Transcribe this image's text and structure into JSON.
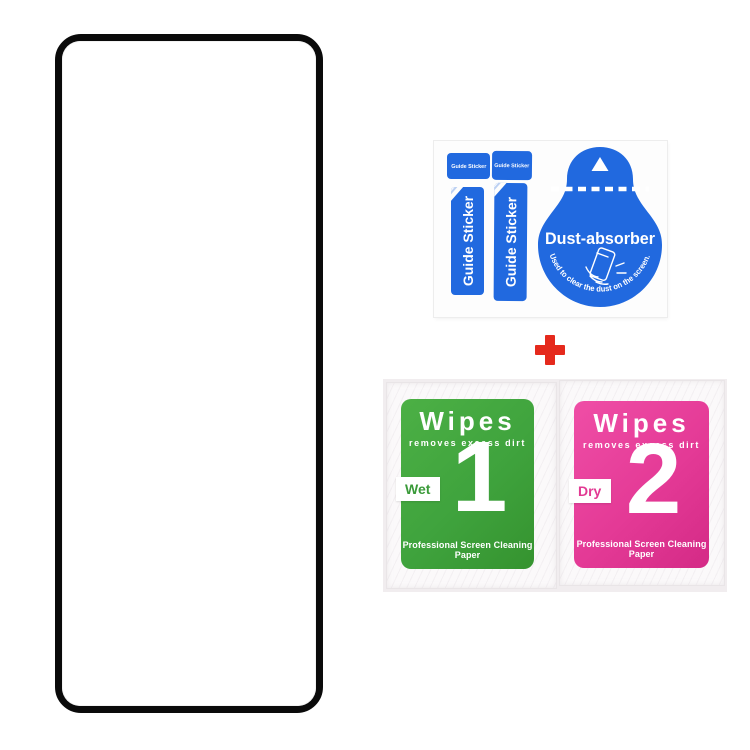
{
  "accessories": {
    "guide_stickers": {
      "tab_labels": [
        "Guide Sticker",
        "Guide Sticker"
      ],
      "strip_labels": [
        "Guide Sticker",
        "Guide Sticker"
      ]
    },
    "dust_absorber": {
      "title": "Dust-absorber",
      "caption": "Used to clear the dust on the screen."
    }
  },
  "separator": {
    "plus": "+"
  },
  "wipes": {
    "packets": [
      {
        "title": "Wipes",
        "subtitle": "removes excess dirt",
        "tab": "Wet",
        "number": "1",
        "footer": "Professional Screen Cleaning Paper"
      },
      {
        "title": "Wipes",
        "subtitle": "removes excess dirt",
        "tab": "Dry",
        "number": "2",
        "footer": "Professional Screen Cleaning Paper"
      }
    ]
  },
  "colors": {
    "blue": "#2169df",
    "green": "#3fa33d",
    "pink": "#e43a96",
    "red": "#e5291c",
    "frame": "#0a0a0a"
  }
}
